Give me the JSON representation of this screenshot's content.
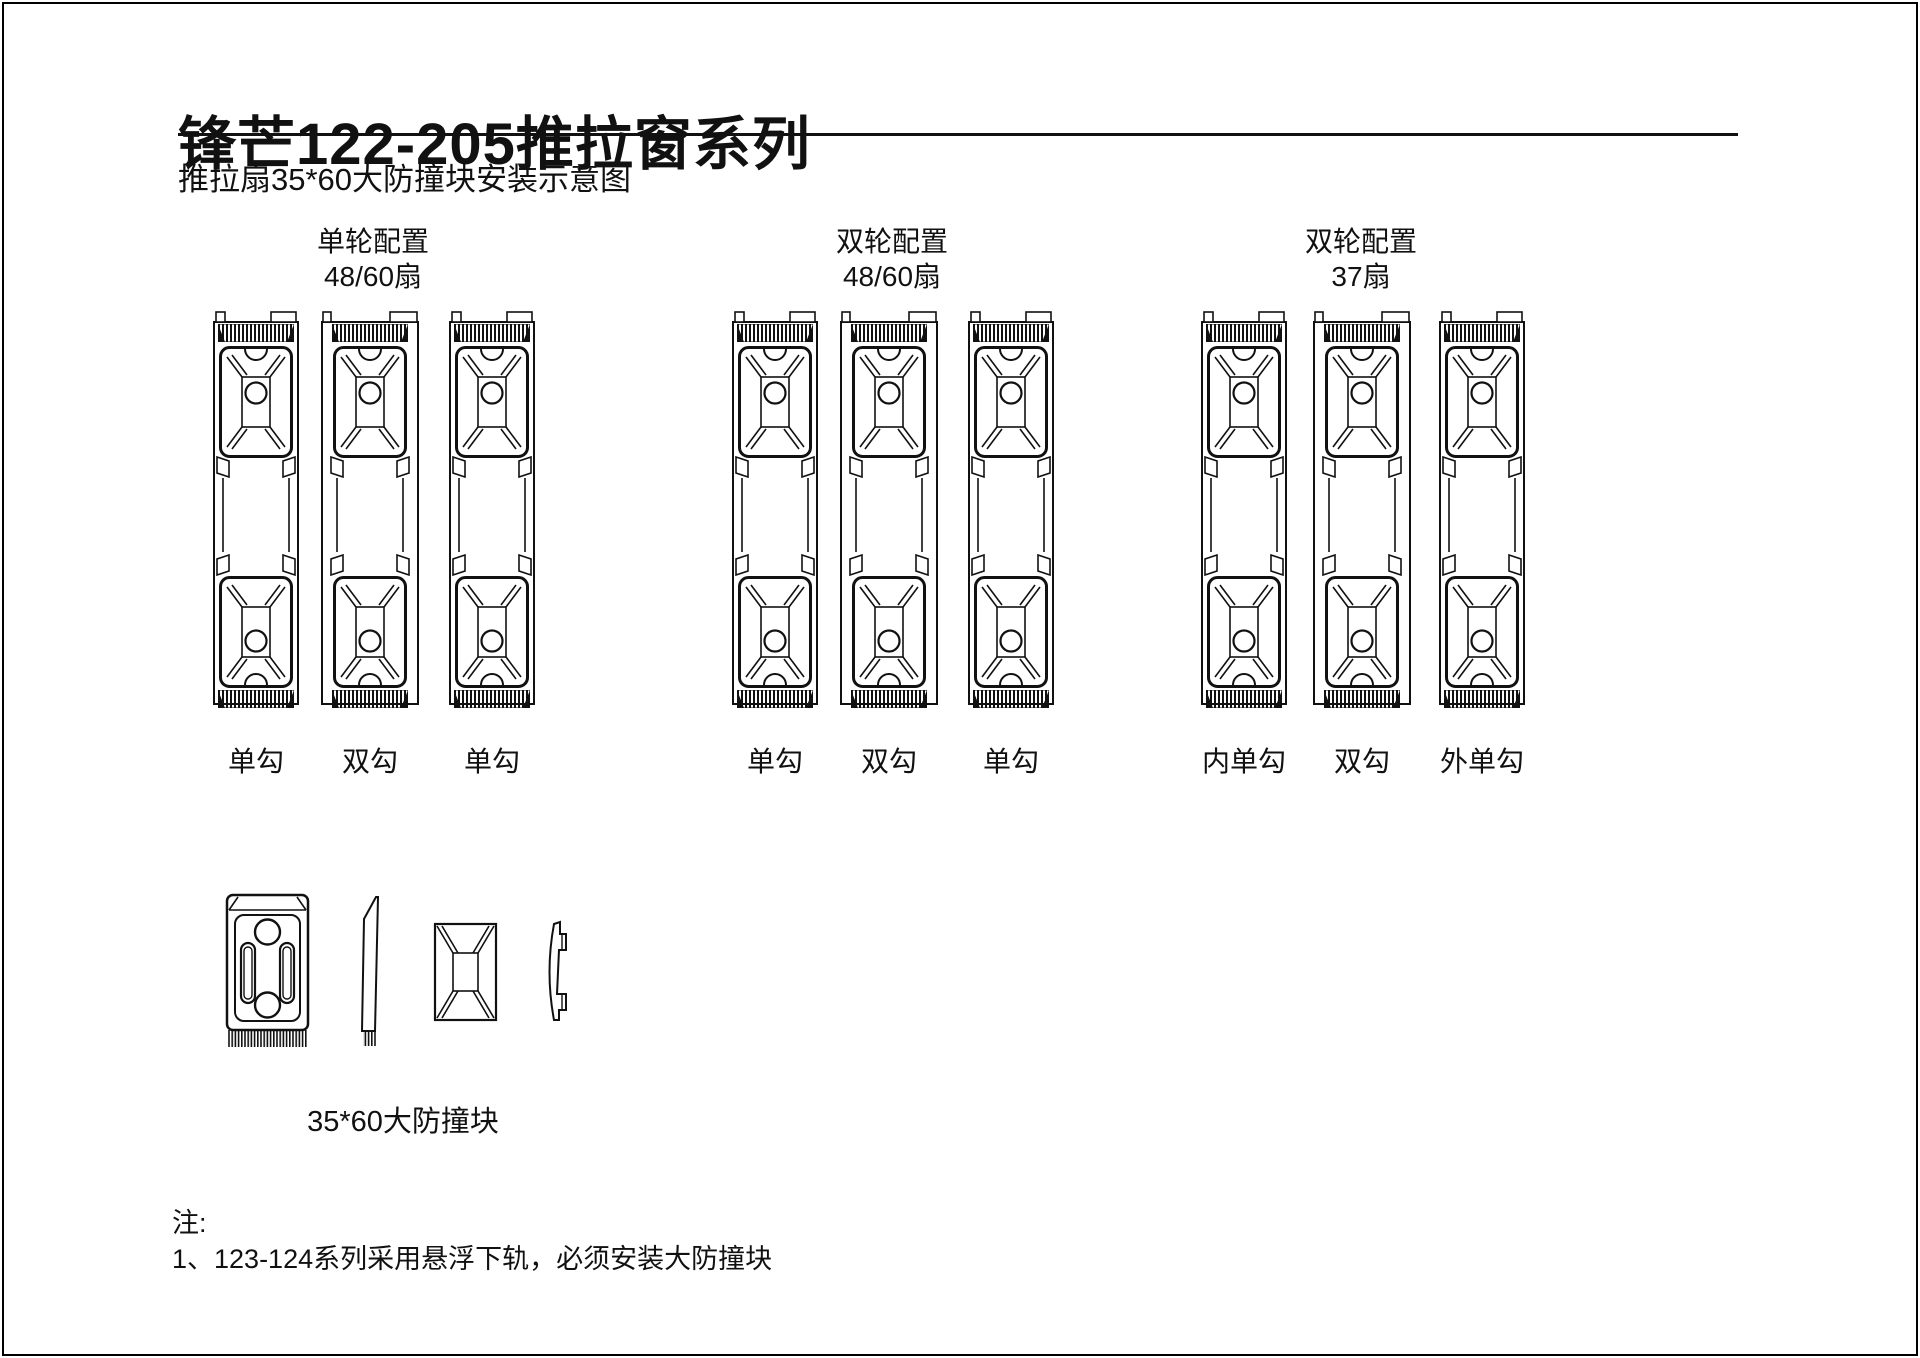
{
  "page": {
    "title": "锋芒122-205推拉窗系列",
    "subtitle": "推拉扇35*60大防撞块安装示意图"
  },
  "groups": [
    {
      "config": "单轮配置",
      "fan": "48/60扇",
      "columns": [
        {
          "label": "单勾",
          "variant": "single-hook"
        },
        {
          "label": "双勾",
          "variant": "double-hook"
        },
        {
          "label": "单勾",
          "variant": "single-hook"
        }
      ]
    },
    {
      "config": "双轮配置",
      "fan": "48/60扇",
      "columns": [
        {
          "label": "单勾",
          "variant": "single-hook"
        },
        {
          "label": "双勾",
          "variant": "double-hook"
        },
        {
          "label": "单勾",
          "variant": "single-hook"
        }
      ]
    },
    {
      "config": "双轮配置",
      "fan": "37扇",
      "columns": [
        {
          "label": "内单勾",
          "variant": "single-hook"
        },
        {
          "label": "双勾",
          "variant": "double-hook"
        },
        {
          "label": "外单勾",
          "variant": "single-hook"
        }
      ]
    }
  ],
  "component": {
    "label": "35*60大防撞块"
  },
  "notes": {
    "heading": "注:",
    "items": [
      "1、123-124系列采用悬浮下轨，必须安装大防撞块"
    ]
  }
}
